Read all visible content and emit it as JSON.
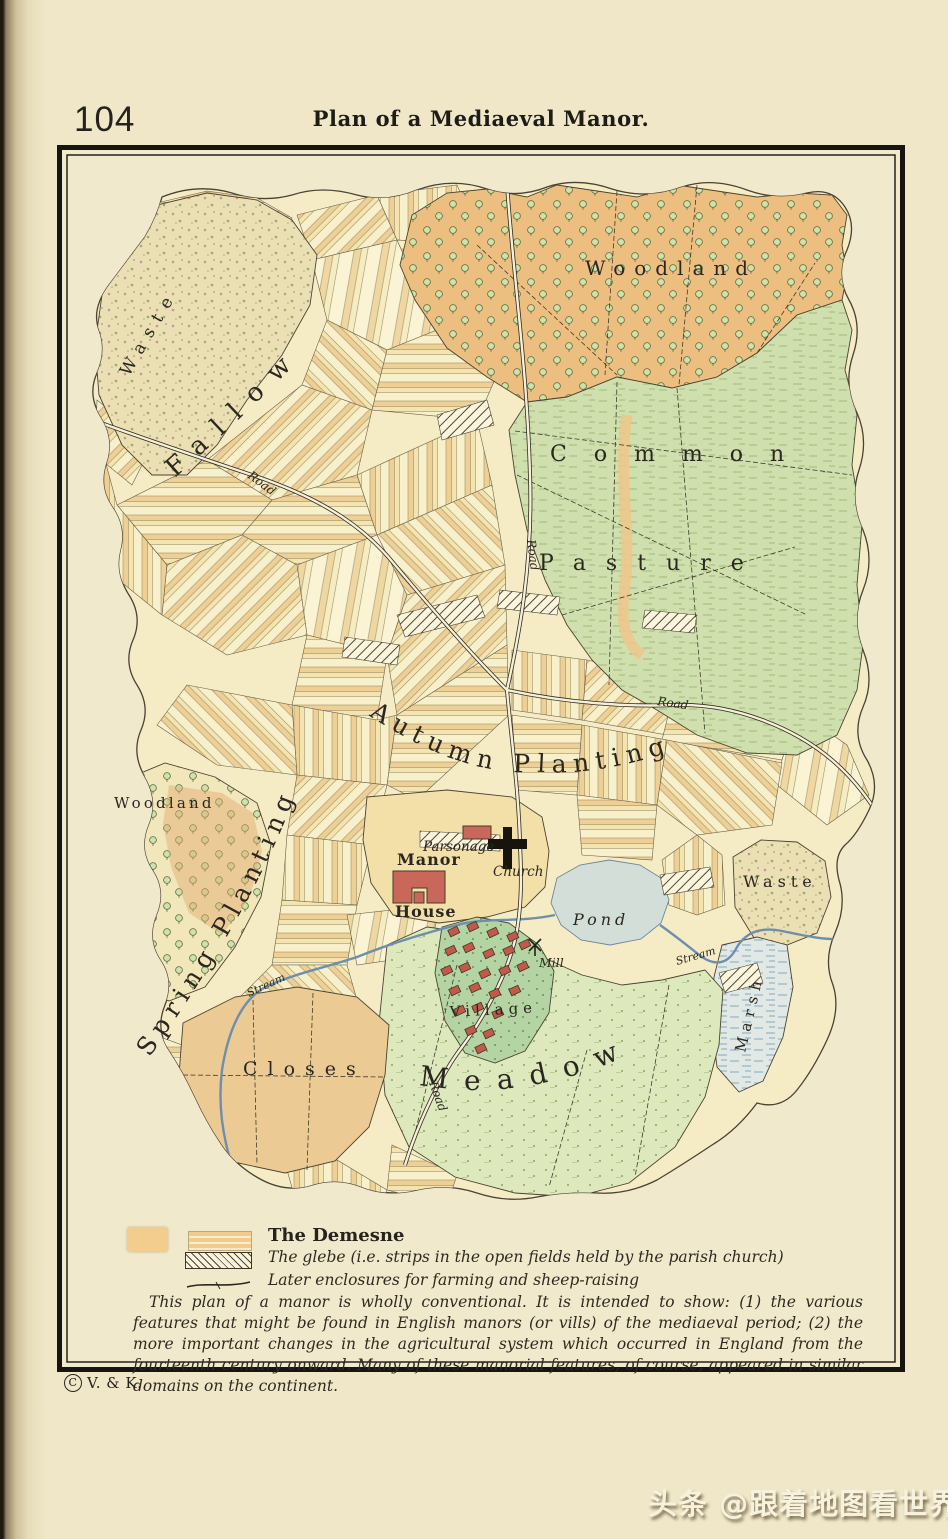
{
  "page": {
    "number": "104",
    "title": "Plan of a Mediaeval Manor."
  },
  "map": {
    "region_labels": {
      "waste_nw": "Waste",
      "fallow": "Fallow",
      "woodland_ne": "Woodland",
      "common": "Common",
      "pasture": "Pasture",
      "autumn_planting": "Autumn Planting",
      "spring_planting": "Spring Planting",
      "woodland_w": "Woodland",
      "waste_e": "Waste",
      "closes": "Closes",
      "meadow": "Meadow",
      "village": "Village",
      "pond": "Pond",
      "mill": "Mill",
      "marsh": "Marsh"
    },
    "place_labels": {
      "manor_line1": "Manor",
      "manor_line2": "House",
      "parsonage": "Parsonage",
      "church": "Church"
    },
    "road_label": "Road",
    "stream_label": "Stream"
  },
  "legend": {
    "demesne_label": "The Demesne",
    "glebe_label": "The glebe (i.e. strips in the open fields held by the parish church)",
    "enclosures_label": "Later enclosures for farming and sheep-raising",
    "note": "This plan of a manor is wholly conventional. It is intended to show: (1) the various features that might be found in English manors (or vills) of the mediaeval period; (2) the more important changes in the agricultural system which occurred in England from the fourteenth century onward. Many of these manorial features, of course, appeared in similar domains on the continent."
  },
  "footer": {
    "copyright_symbol": "C",
    "copyright": "V. & K."
  },
  "watermark": "头条 @跟着地图看世界",
  "colors": {
    "paper": "#efe7c8",
    "map_base": "#f5ecc6",
    "demesne_orange": "#eec27f",
    "pasture_green": "#cfe0ae",
    "meadow_green": "#dde9bd",
    "pond_blue": "#d3ded9",
    "village_green": "#b4d4a4",
    "house_red": "#c25a4a",
    "stream_blue": "#6d8fae",
    "ink": "#2b2721"
  }
}
